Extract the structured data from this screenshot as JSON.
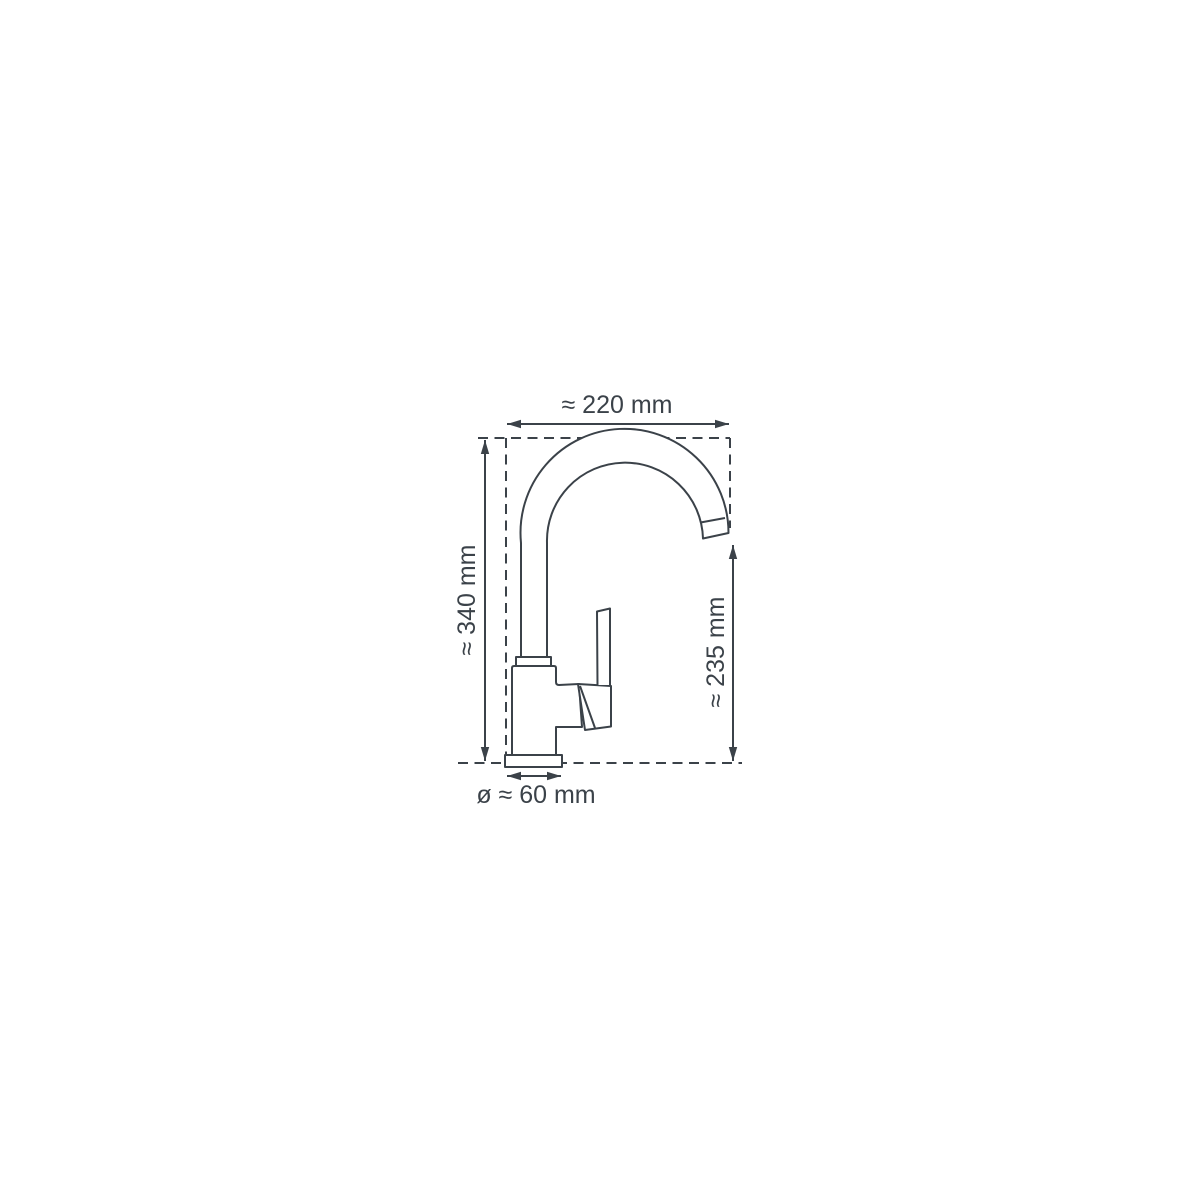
{
  "page": {
    "background": "#ffffff"
  },
  "diagram": {
    "subject": "kitchen-faucet-dimension-drawing",
    "line_color": "#3b4249",
    "labels": {
      "width": "≈ 220 mm",
      "height": "≈ 340 mm",
      "spout_height": "≈ 235 mm",
      "base_diameter": "ø ≈ 60 mm"
    }
  }
}
